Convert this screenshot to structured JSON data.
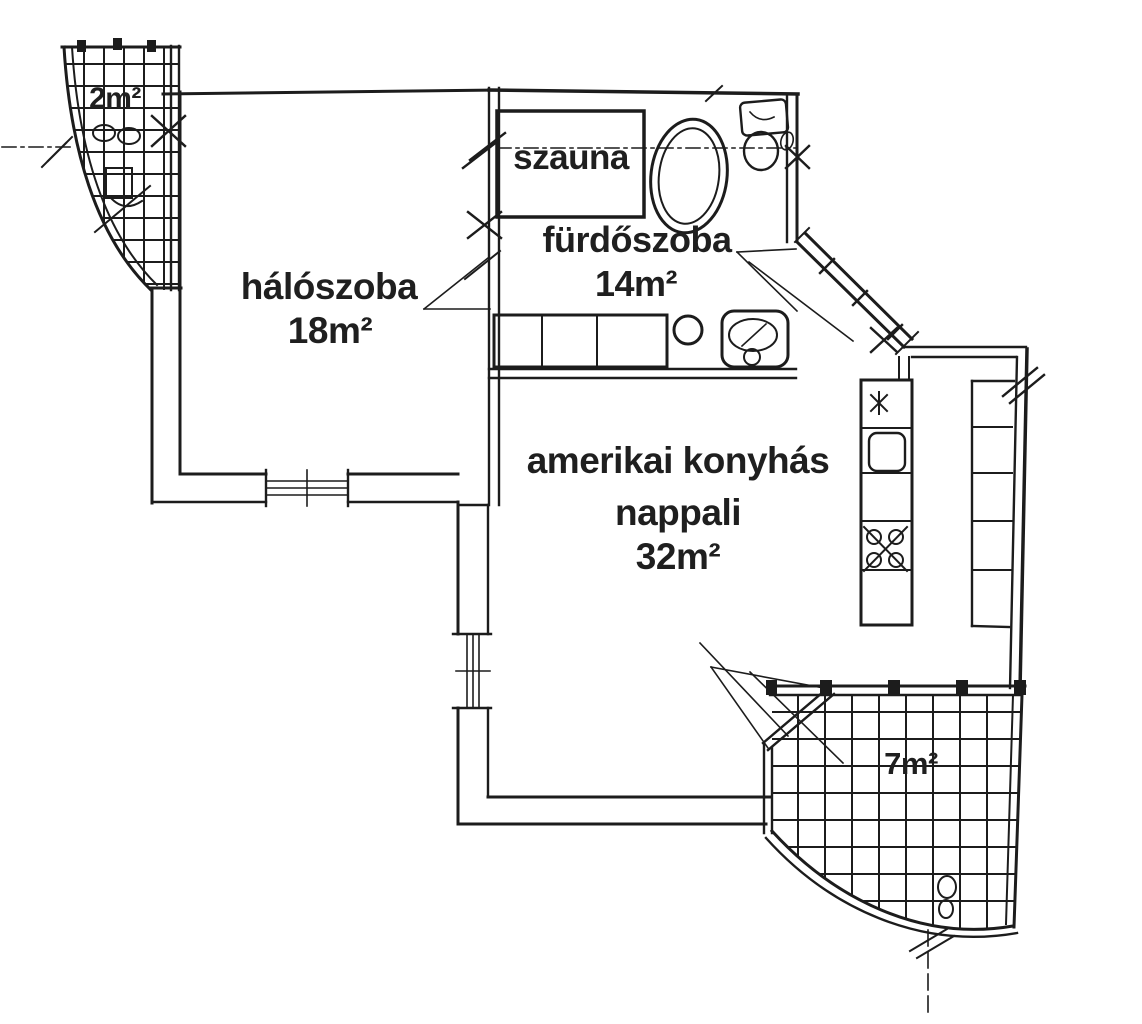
{
  "colors": {
    "ink": "#1c1c1c",
    "paper": "#ffffff"
  },
  "plan_language": "Hungarian",
  "rooms": {
    "small_balcony": {
      "area_label": "2m²",
      "area_m2": 2
    },
    "bedroom": {
      "name": "hálószoba",
      "area_label": "18m²",
      "area_m2": 18
    },
    "sauna": {
      "name": "szauna"
    },
    "bathroom": {
      "name": "fürdőszoba",
      "area_label": "14m²",
      "area_m2": 14
    },
    "living_room": {
      "name_line1": "amerikai konyhás",
      "name_line2": "nappali",
      "area_label": "32m²",
      "area_m2": 32
    },
    "large_balcony": {
      "area_label": "7m²",
      "area_m2": 7
    }
  },
  "fixtures": [
    "bathtub",
    "toilet",
    "washbasin",
    "vanity-counter",
    "wc",
    "sauna-cabin",
    "kitchen-counter",
    "kitchen-sink",
    "stove",
    "shelf-counter",
    "balcony-table",
    "balcony-chairs",
    "window",
    "entrance-door",
    "balcony-door"
  ]
}
